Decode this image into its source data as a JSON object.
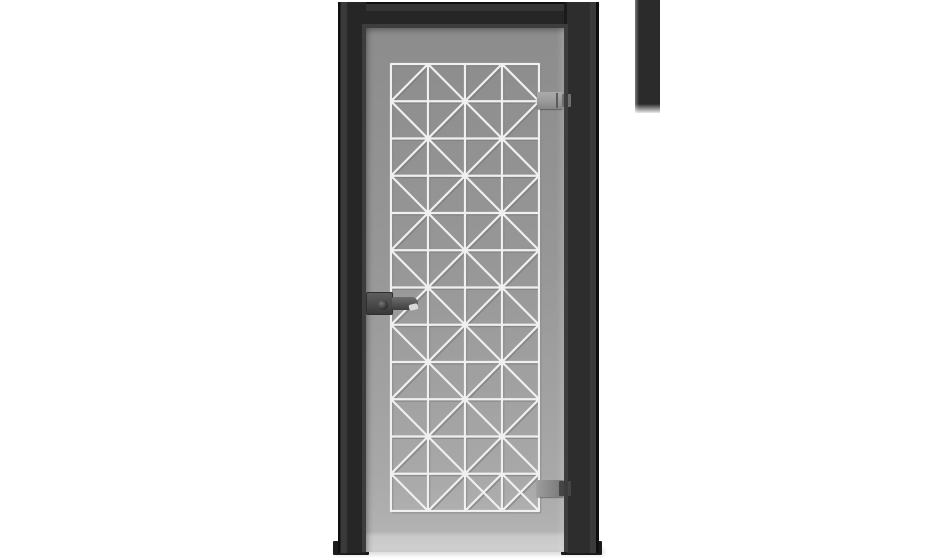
{
  "scene": {
    "background_color": "#ffffff",
    "artifact_bar_color": "#2b2b2b"
  },
  "door": {
    "frame_color": "#262626",
    "frame_bevel_color": "#3d3d3d",
    "glass": {
      "top_color": "#8c8c8c",
      "bottom_color": "#b2b2b2",
      "edge_color": "#c9c9c9"
    },
    "lattice": {
      "columns": 4,
      "rows": 12,
      "line_color": "#f0f0f0",
      "line_shadow_color": "#777777",
      "pattern": [
        [
          "/",
          "\\",
          "/",
          "\\"
        ],
        [
          "\\",
          "/",
          "\\",
          "/"
        ],
        [
          "/",
          "\\",
          "/",
          "\\"
        ],
        [
          "\\",
          "/",
          "\\",
          "/"
        ],
        [
          "/",
          "\\",
          "/",
          "\\"
        ],
        [
          "\\",
          "/",
          "\\",
          "/"
        ],
        [
          "/",
          "\\",
          "/",
          "\\"
        ],
        [
          "\\",
          "/",
          "\\",
          "/"
        ],
        [
          "/",
          "\\",
          "/",
          "\\"
        ],
        [
          "\\",
          "/",
          "\\",
          "/"
        ],
        [
          "/",
          "\\",
          "/",
          "\\"
        ],
        [
          "\\",
          "/",
          "X",
          "X"
        ]
      ]
    },
    "hardware": {
      "handle_color": "#4a4a4a",
      "hinge_color": "#9a9a9a",
      "hinge_clamp_color": "#5a5a5a",
      "hinge_count": 2
    }
  }
}
